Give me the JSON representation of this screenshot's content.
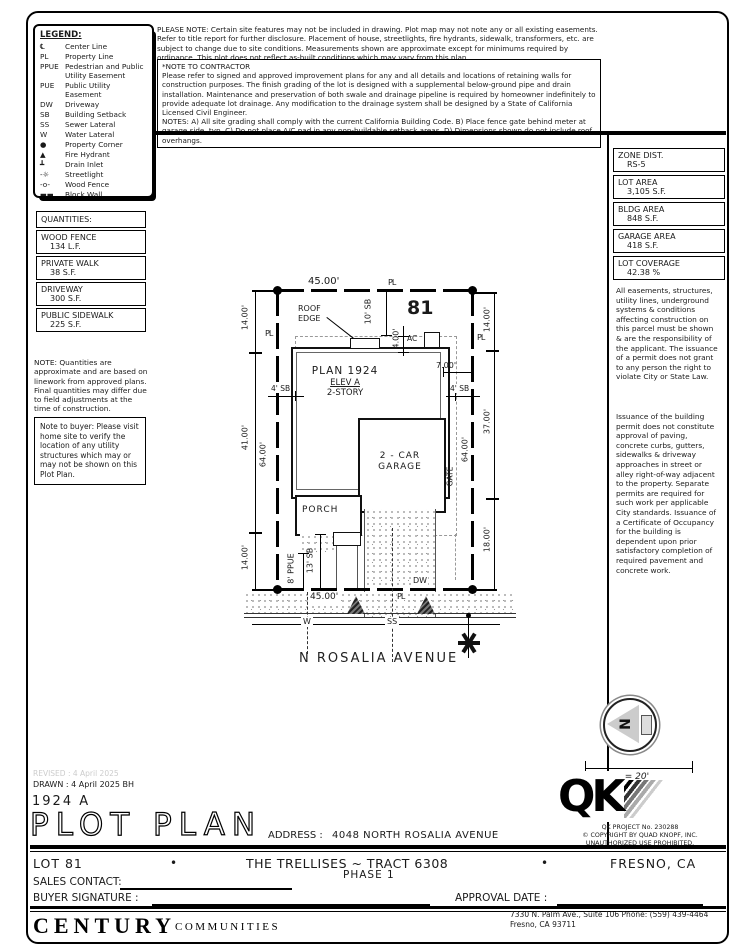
{
  "legend": {
    "title": "LEGEND:",
    "items": [
      {
        "symbol": "℄",
        "label": "Center Line"
      },
      {
        "symbol": "PL",
        "label": "Property Line"
      },
      {
        "symbol": "PPUE",
        "label": "Pedestrian and Public Utility Easement"
      },
      {
        "symbol": "PUE",
        "label": "Public Utility Easement"
      },
      {
        "symbol": "DW",
        "label": "Driveway"
      },
      {
        "symbol": "SB",
        "label": "Building Setback"
      },
      {
        "symbol": "SS",
        "label": "Sewer Lateral"
      },
      {
        "symbol": "W",
        "label": "Water Lateral"
      },
      {
        "symbol": "●",
        "label": "Property Corner"
      },
      {
        "symbol": "▲",
        "label": "Fire Hydrant"
      },
      {
        "symbol": "┻",
        "label": "Drain Inlet"
      },
      {
        "symbol": "-☼",
        "label": "Streetlight"
      },
      {
        "symbol": "-o-",
        "label": "Wood Fence"
      },
      {
        "symbol": "▬▬",
        "label": "Block Wall"
      },
      {
        "symbol": "▨",
        "label": "Concrete"
      }
    ]
  },
  "top_notes": {
    "please_note": "PLEASE NOTE:  Certain site features may not be included in drawing.  Plot map may not note any or all existing easements.  Refer to title report for further disclosure.  Placement of house, streetlights, fire hydrants, sidewalk, transformers, etc. are subject to change due to site conditions.  Measurements shown are approximate except for minimums required by ordinance.  This plot does not reflect as-built conditions which may vary from this plan.",
    "contractor_title": "*NOTE TO CONTRACTOR",
    "contractor_body": "Please refer to signed and approved improvement plans for any and all details and locations of retaining walls for construction purposes. The finish grading of the lot is designed with a supplemental below-ground pipe and drain installation.  Maintenance and preservation of both swale and drainage pipeline is required by homeowner indefinitely to provide adequate lot drainage.  Any modification to the drainage system shall be designed by a State of California Licensed Civil Engineer.",
    "contractor_notes": "NOTES:  A) All site grading shall comply with the current California Building Code.  B) Place fence gate behind meter at garage side, typ.  C) Do not place A/C pad in any non-buildable setback areas.  D) Dimensions shown do not include roof overhangs."
  },
  "zone_table": {
    "rows": [
      {
        "label": "ZONE DIST.",
        "value": "RS-5"
      },
      {
        "label": "LOT AREA",
        "value": "3,105 S.F."
      },
      {
        "label": "BLDG AREA",
        "value": "848 S.F."
      },
      {
        "label": "GARAGE AREA",
        "value": "418 S.F."
      },
      {
        "label": "LOT COVERAGE",
        "value": "42.38 %"
      }
    ]
  },
  "right_notes": {
    "p1": "All easements, structures, utility lines, underground systems & conditions affecting construction on this parcel must be shown & are the responsibility of the applicant. The issuance of a permit does not grant to any person the right to violate City or State Law.",
    "p2": "Issuance of the building permit does not constitute approval of paving, concrete curbs, gutters, sidewalks & driveway approaches in street or alley right-of-way adjacent to the property. Separate permits are required for such work per applicable City standards. Issuance of a Certificate of Occupancy for the building is dependent upon prior satisfactory completion of required pavement and concrete work."
  },
  "quantities": {
    "title": "QUANTITIES:",
    "rows": [
      {
        "label": "WOOD FENCE",
        "value": "134 L.F."
      },
      {
        "label": "PRIVATE WALK",
        "value": "38 S.F."
      },
      {
        "label": "DRIVEWAY",
        "value": "300 S.F."
      },
      {
        "label": "PUBLIC SIDEWALK",
        "value": "225 S.F."
      }
    ],
    "note": "NOTE: Quantities are approximate and are based on linework from approved plans.  Final quantities may differ due to field adjustments at the time of construction."
  },
  "buyer_note": "Note to buyer: Please visit home site to verify the location of any utility structures which may or may not be shown on this Plot Plan.",
  "plot": {
    "lot_number": "81",
    "plan_line1": "PLAN 1924",
    "plan_line2": "ELEV A",
    "plan_line3": "2-STORY",
    "roof_edge": "ROOF\nEDGE",
    "ac": "AC",
    "garage": "2 - CAR\nGARAGE",
    "porch": "PORCH",
    "gate": "GATE",
    "dw": "DW",
    "water": "W",
    "sewer": "SS",
    "pl": "PL",
    "street_name": "N ROSALIA AVENUE",
    "dims": {
      "top": "45.00'",
      "bottom": "45.00'",
      "left_outer": [
        "14.00'",
        "41.00'",
        "14.00'"
      ],
      "left_inner": "64.00'",
      "right_outer": [
        "14.00'",
        "37.00'",
        "18.00'"
      ],
      "right_inner": "64.00'",
      "sb_top": "10' SB",
      "d4": "4.00'",
      "d7": "7.00'",
      "sb4_left": "4' SB",
      "sb4_right": "4' SB",
      "ppue": "8' PPUE",
      "sb13": "13' SB"
    }
  },
  "compass": {
    "north": "N",
    "scale": "1\" = 20'"
  },
  "titleblock": {
    "revised": "REVISED :  4 April 2025",
    "drawn": "DRAWN :  4 April 2025   BH",
    "plan_number": "1924  A",
    "title": "PLOT PLAN",
    "address_label": "ADDRESS :",
    "address": "4048 NORTH ROSALIA AVENUE",
    "qk": "QK",
    "qk_project": "QK PROJECT No. 230288",
    "qk_copy1": "©  COPYRIGHT BY QUAD KNOPF, INC.",
    "qk_copy2": "UNAUTHORIZED USE PROHIBITED.",
    "lot": "LOT 81",
    "bullet": "•",
    "tract": "THE TRELLISES ~ TRACT 6308",
    "phase": "PHASE 1",
    "city": "FRESNO, CA",
    "sales_label": "SALES CONTACT:",
    "buyer_label": "BUYER SIGNATURE :",
    "approval_label": "APPROVAL DATE :",
    "century": "CENTURY",
    "communities": "COMMUNITIES",
    "office_line1": "7330 N. Palm Ave., Suite 106    Phone:  (559) 439-4464",
    "office_line2": "Fresno, CA  93711"
  }
}
